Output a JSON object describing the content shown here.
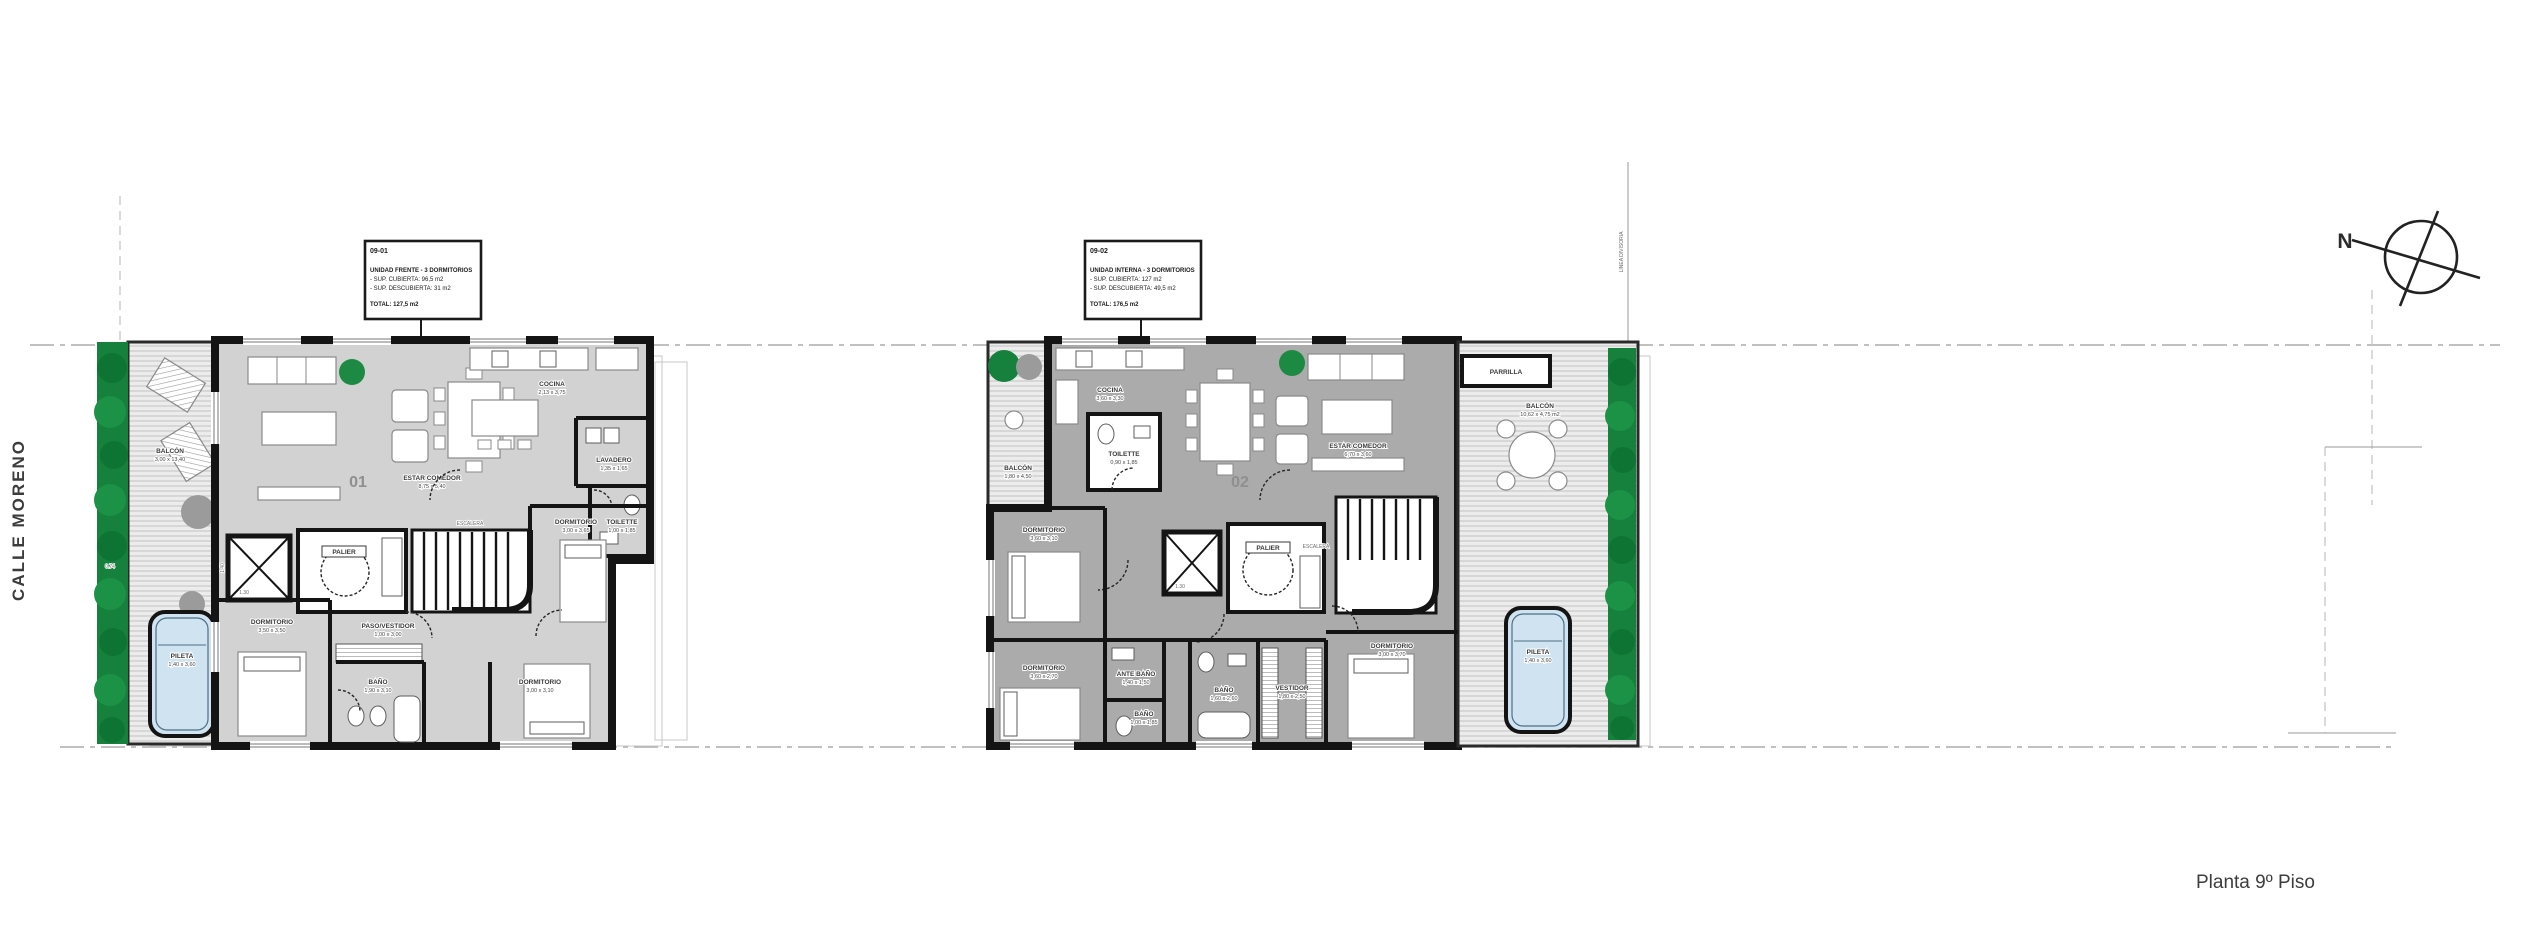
{
  "street": {
    "label": "CALLE MORENO"
  },
  "plan_title": {
    "label": "Planta 9º Piso"
  },
  "compass": {
    "label": "N"
  },
  "measurements": {
    "left_dim": "0.74",
    "boundary_note": "LINEA DIVISORIA"
  },
  "info_box_1": {
    "unit_code": "09-01",
    "type_line": "UNIDAD FRENTE - 3 DORMITORIOS",
    "covered": "- SUP. CUBIERTA: 96,5 m2",
    "uncovered": "- SUP. DESCUBIERTA: 31 m2",
    "total": "TOTAL: 127,5 m2"
  },
  "info_box_2": {
    "unit_code": "09-02",
    "type_line": "UNIDAD INTERNA - 3 DORMITORIOS",
    "covered": "- SUP. CUBIERTA: 127 m2",
    "uncovered": "- SUP. DESCUBIERTA: 49,5 m2",
    "total": "TOTAL: 176,5 m2"
  },
  "unit1": {
    "number": "01",
    "balcon": {
      "name": "BALCÓN",
      "dims": "3,00 x 13,40"
    },
    "pileta": {
      "name": "PILETA",
      "dims": "1,40 x 3,60"
    },
    "estar": {
      "name": "ESTAR COMEDOR",
      "dims": "8,75 x 5,40"
    },
    "cocina": {
      "name": "COCINA",
      "dims": "2,13 x 3,75"
    },
    "lavadero": {
      "name": "LAVADERO",
      "dims": "1,35 x 1,65"
    },
    "toilette": {
      "name": "TOILETTE",
      "dims": "1,00 x 1,85"
    },
    "palier": {
      "name": "PALIER"
    },
    "escalera": {
      "name": "ESCALERA"
    },
    "elev_w": "1.40",
    "elev_d": "1.30",
    "paso": {
      "name": "PASO/VESTIDOR",
      "dims": "1,00 x 3,00"
    },
    "dorm1": {
      "name": "DORMITORIO",
      "dims": "3,50 x 3,50"
    },
    "bano": {
      "name": "BAÑO",
      "dims": "1,90 x 3,10"
    },
    "dorm2": {
      "name": "DORMITORIO",
      "dims": "3,00 x 3,10"
    },
    "dorm3": {
      "name": "DORMITORIO",
      "dims": "3,00 x 3,65"
    }
  },
  "unit2": {
    "number": "02",
    "balcon_l": {
      "name": "BALCÓN",
      "dims": "1,80 x 4,50"
    },
    "balcon_r": {
      "name": "BALCÓN",
      "dims": "10,62 x 4,75 m2"
    },
    "parrilla": {
      "name": "PARRILLA"
    },
    "pileta": {
      "name": "PILETA",
      "dims": "1,40 x 3,60"
    },
    "cocina": {
      "name": "COCINA",
      "dims": "3,60 x 3,30"
    },
    "toilette": {
      "name": "TOILETTE",
      "dims": "0,90 x 1,85"
    },
    "estar": {
      "name": "ESTAR COMEDOR",
      "dims": "6,70 x 3,60"
    },
    "palier": {
      "name": "PALIER"
    },
    "escalera": {
      "name": "ESCALERA"
    },
    "elev_d": "1.30",
    "dorm1": {
      "name": "DORMITORIO",
      "dims": "3,60 x 3,10"
    },
    "dorm2": {
      "name": "DORMITORIO",
      "dims": "3,60 x 2,70"
    },
    "antebano": {
      "name": "ANTE BAÑO",
      "dims": "1,40 x 1,50"
    },
    "bano_chico": {
      "name": "BAÑO",
      "dims": "1,00 x 1,85"
    },
    "bano": {
      "name": "BAÑO",
      "dims": "1,60 x 2,60"
    },
    "vestidor": {
      "name": "VESTIDOR",
      "dims": "1,80 x 2,50"
    },
    "dorm3": {
      "name": "DORMITORIO",
      "dims": "3,00 x 3,70"
    }
  },
  "colors": {
    "planter_green": "#15813c",
    "pool_water": "#cfe3f0",
    "floor_light": "#d2d2d2",
    "floor_dark": "#ababab",
    "wall": "#141414"
  }
}
